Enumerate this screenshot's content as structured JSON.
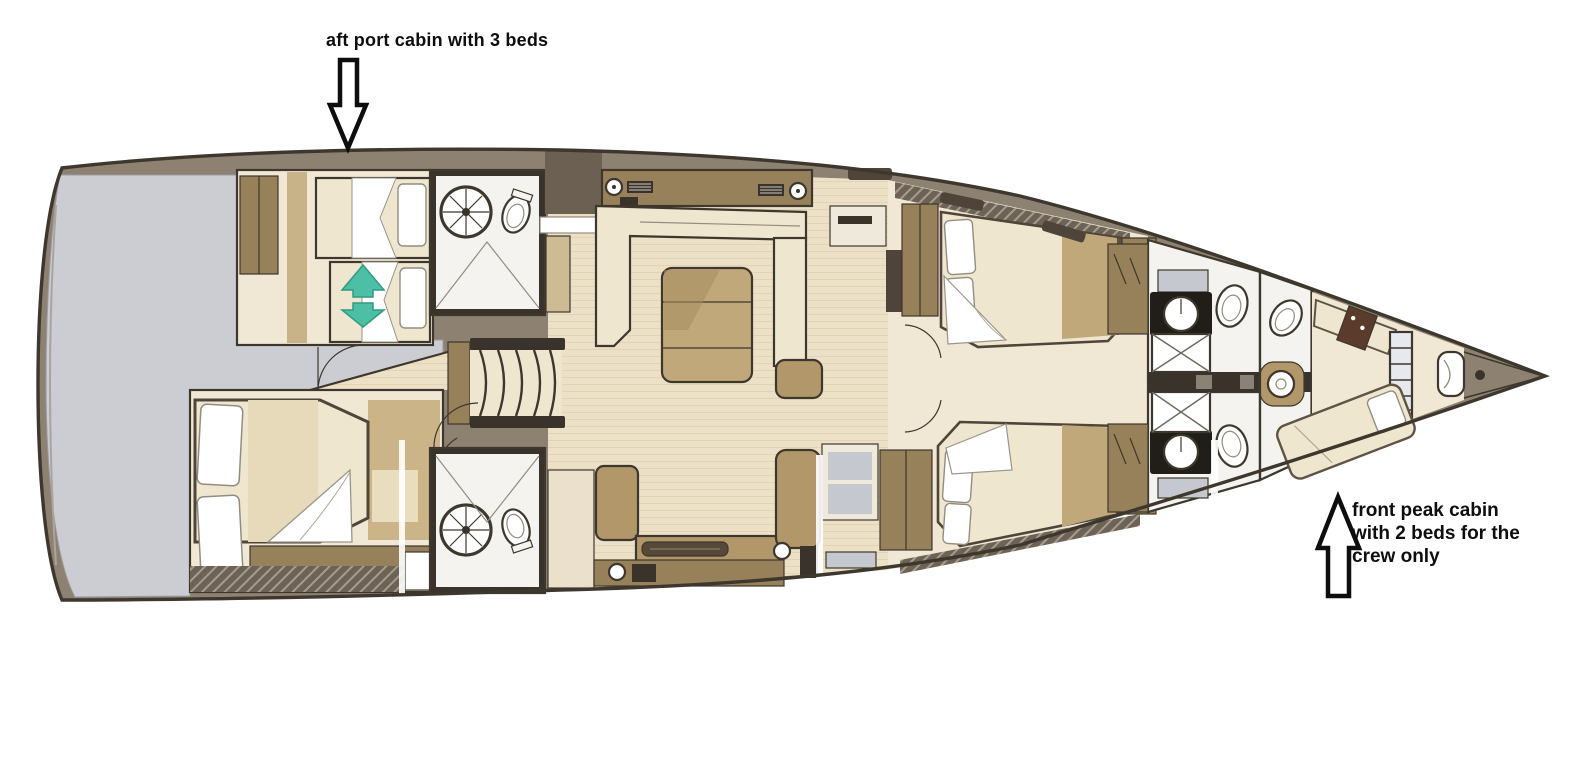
{
  "annotations": {
    "aft_port_cabin": {
      "text": "aft port cabin with 3 beds"
    },
    "front_peak_cabin": {
      "lines": [
        "front peak cabin",
        "with 2 beds for the",
        "crew only"
      ]
    }
  },
  "icons": {
    "aft_pointer": "block-arrow-down",
    "peak_pointer": "block-arrow-up",
    "convertible_bed": "teal-double-arrow"
  },
  "colors": {
    "page_bg": "#ffffff",
    "hull_deck": "#8d8172",
    "hull_line": "#3e372d",
    "interior_floor": "#f0e8d5",
    "wood_floor": "#ece0c6",
    "wood_stripe": "#e1d4b5",
    "platform_gray": "#cbcdd3",
    "furniture_tan": "#b1976a",
    "furniture_tan_dark": "#97815a",
    "bed_cream": "#efe6d0",
    "bed_tan": "#c0a87a",
    "linen_white": "#ffffff",
    "trim_dark": "#3a332b",
    "fixture_white": "#f4f3ef",
    "teal_accent": "#4dbfa4",
    "teal_accent_dark": "#2f9b83",
    "annotation_ink": "#0e0e0e"
  }
}
